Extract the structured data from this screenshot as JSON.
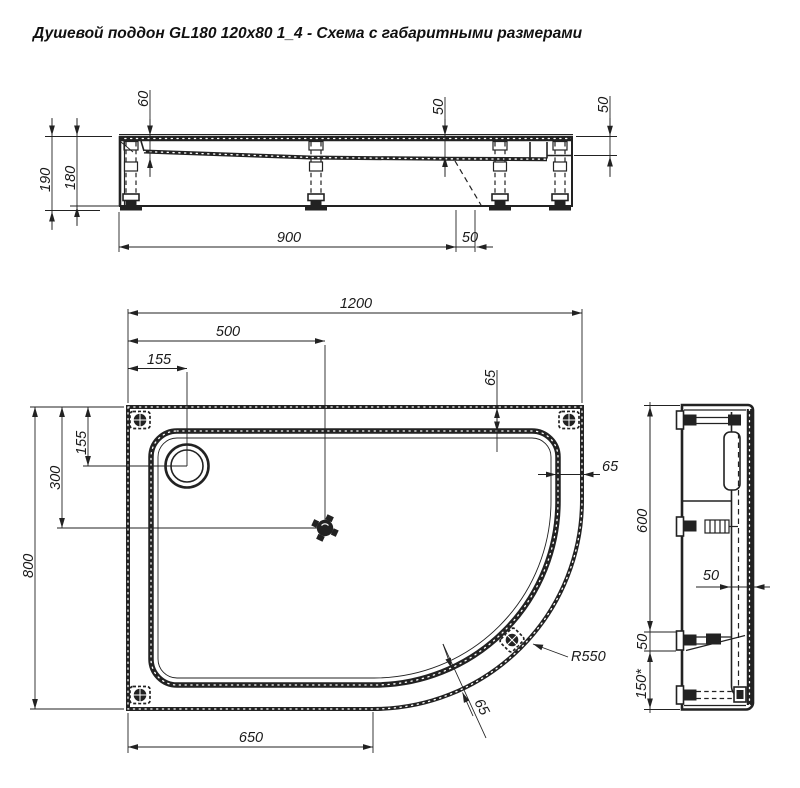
{
  "title": "Душевой поддон GL180 120x80 1_4 - Схема с габаритными размерами",
  "plan_view": {
    "dims": {
      "width": "1200",
      "drain_offset_x": "500",
      "circle_offset_x": "155",
      "rim_width_top": "65",
      "circle_offset_y": "155",
      "drain_offset_y": "300",
      "depth": "800",
      "rim_width_right": "65",
      "bottom_straight": "650",
      "rim_width_corner": "65",
      "corner_radius": "R550"
    }
  },
  "front_view": {
    "dims": {
      "basin_depth": "60",
      "rim_drop_mid": "50",
      "rim_drop_right": "50",
      "total_height": "190",
      "body_height": "180",
      "feet_span": "900",
      "feet_offset": "50"
    }
  },
  "side_view": {
    "dims": {
      "upper_span": "600",
      "foot_height": "50",
      "foot_to_edge": "150*",
      "rim_width": "50"
    }
  },
  "colors": {
    "line": "#222222",
    "background": "#ffffff"
  }
}
